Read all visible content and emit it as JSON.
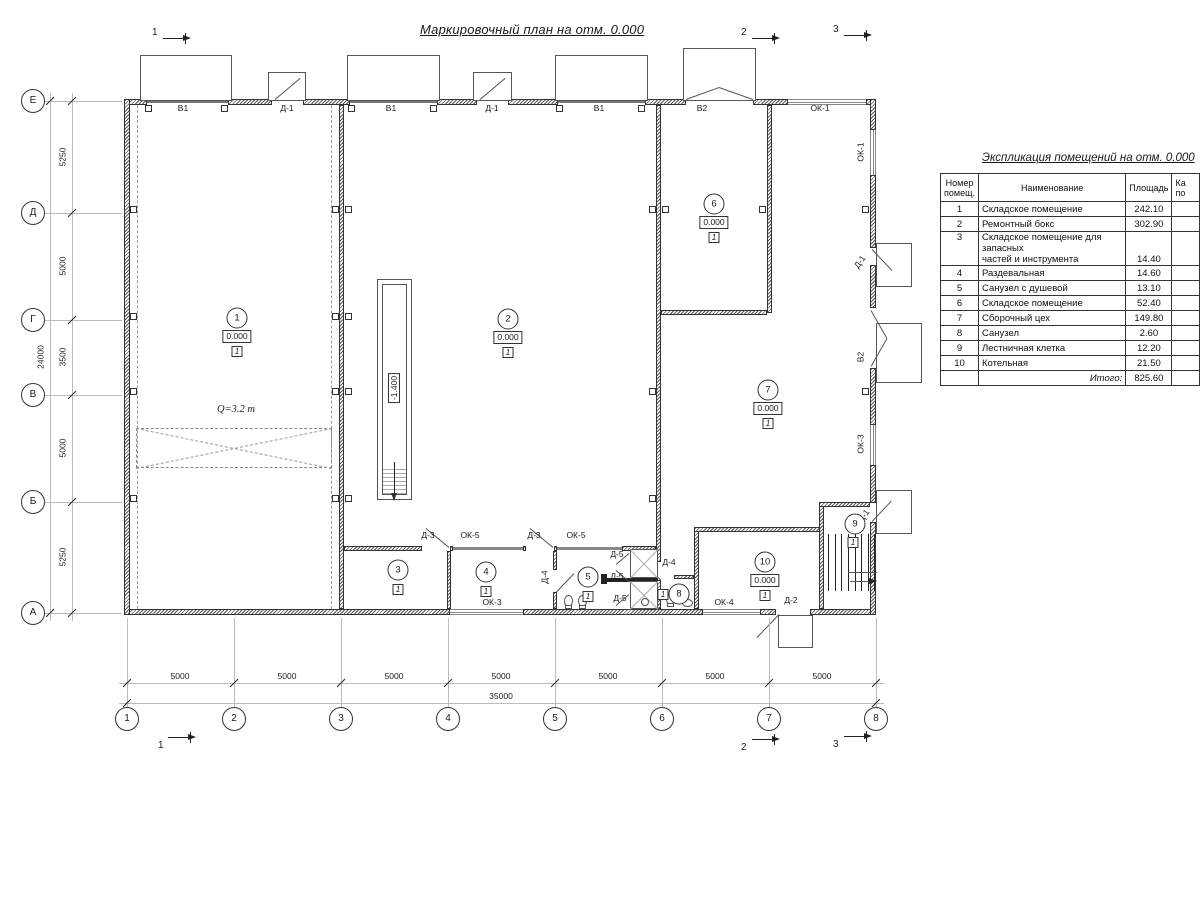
{
  "plan": {
    "title": "Маркировочный план на отм. 0.000",
    "crane_label": "Q=3.2 т",
    "pit_elevation": "-1.400",
    "sections_top": [
      "1",
      "2",
      "3"
    ],
    "sections_bottom": [
      "1",
      "2",
      "3"
    ],
    "openings": {
      "top": [
        "В1",
        "Д-1",
        "В1",
        "Д-1",
        "В1",
        "В2",
        "ОК-1"
      ],
      "right": [
        "ОК-1",
        "Д-1",
        "В2",
        "ОК-3",
        "Д-1"
      ],
      "strip": [
        "Д-3",
        "ОК-5",
        "Д-3",
        "ОК-5"
      ],
      "bottom": [
        "ОК-3",
        "ОК-4",
        "Д-2"
      ],
      "inner": [
        "Д-5",
        "Д-5",
        "Д-5",
        "Д-4",
        "Д-4"
      ]
    },
    "rooms": [
      {
        "num": "1",
        "elev": "0.000",
        "cat": "1"
      },
      {
        "num": "2",
        "elev": "0.000",
        "cat": "1"
      },
      {
        "num": "3",
        "cat": "1"
      },
      {
        "num": "4",
        "cat": "1"
      },
      {
        "num": "5",
        "cat": "1"
      },
      {
        "num": "6",
        "elev": "0.000",
        "cat": "1"
      },
      {
        "num": "7",
        "elev": "0.000",
        "cat": "1"
      },
      {
        "num": "8",
        "cat": "1"
      },
      {
        "num": "9",
        "cat": "1"
      },
      {
        "num": "10",
        "elev": "0.000",
        "cat": "1"
      }
    ]
  },
  "axes": {
    "cols": [
      "1",
      "2",
      "3",
      "4",
      "5",
      "6",
      "7",
      "8"
    ],
    "rows": [
      "Е",
      "Д",
      "Г",
      "В",
      "Б",
      "А"
    ],
    "col_dims": [
      "5000",
      "5000",
      "5000",
      "5000",
      "5000",
      "5000",
      "5000"
    ],
    "col_total": "35000",
    "row_dims": [
      "5250",
      "5000",
      "3500",
      "5000",
      "5250"
    ],
    "row_total": "24000"
  },
  "table": {
    "title": "Экспликация помещений на отм. 0.000",
    "headers": {
      "num1": "Номер",
      "num2": "помещ.",
      "name": "Наименование",
      "area": "Площадь",
      "cat1": "Ка",
      "cat2": "по"
    },
    "rows": [
      {
        "num": "1",
        "name": "Складское помещение",
        "area": "242.10"
      },
      {
        "num": "2",
        "name": "Ремонтный бокс",
        "area": "302.90"
      },
      {
        "num": "3",
        "name": "Складское помещение для запасных",
        "name2": "частей и инструмента",
        "area": "14.40"
      },
      {
        "num": "4",
        "name": "Раздевальная",
        "area": "14.60"
      },
      {
        "num": "5",
        "name": "Санузел с душевой",
        "area": "13.10"
      },
      {
        "num": "6",
        "name": "Складское помещение",
        "area": "52.40"
      },
      {
        "num": "7",
        "name": "Сборочный цех",
        "area": "149.80"
      },
      {
        "num": "8",
        "name": "Санузел",
        "area": "2.60"
      },
      {
        "num": "9",
        "name": "Лестничная клетка",
        "area": "12.20"
      },
      {
        "num": "10",
        "name": "Котельная",
        "area": "21.50"
      },
      {
        "num": "",
        "name": "Итого:",
        "area": "825.60",
        "total": true
      }
    ]
  }
}
